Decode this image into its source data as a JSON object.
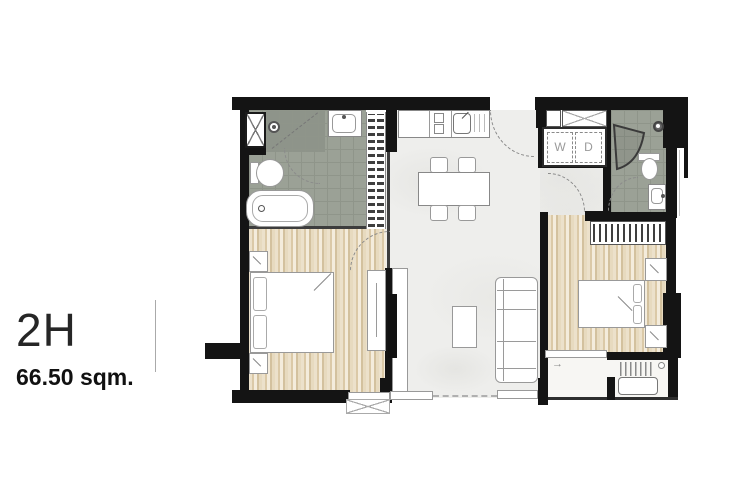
{
  "unit": {
    "code": "2H",
    "area": "66.50 sqm."
  },
  "appliances": {
    "washer": "W",
    "dryer": "D"
  },
  "icons": {
    "slope_arrow": "→"
  },
  "colors": {
    "wall": "#141414",
    "bathroom_tile": "#9ba196",
    "wood_floor": "#e7dabf",
    "marble_floor": "#eeeeec",
    "furniture_outline": "#999999"
  }
}
